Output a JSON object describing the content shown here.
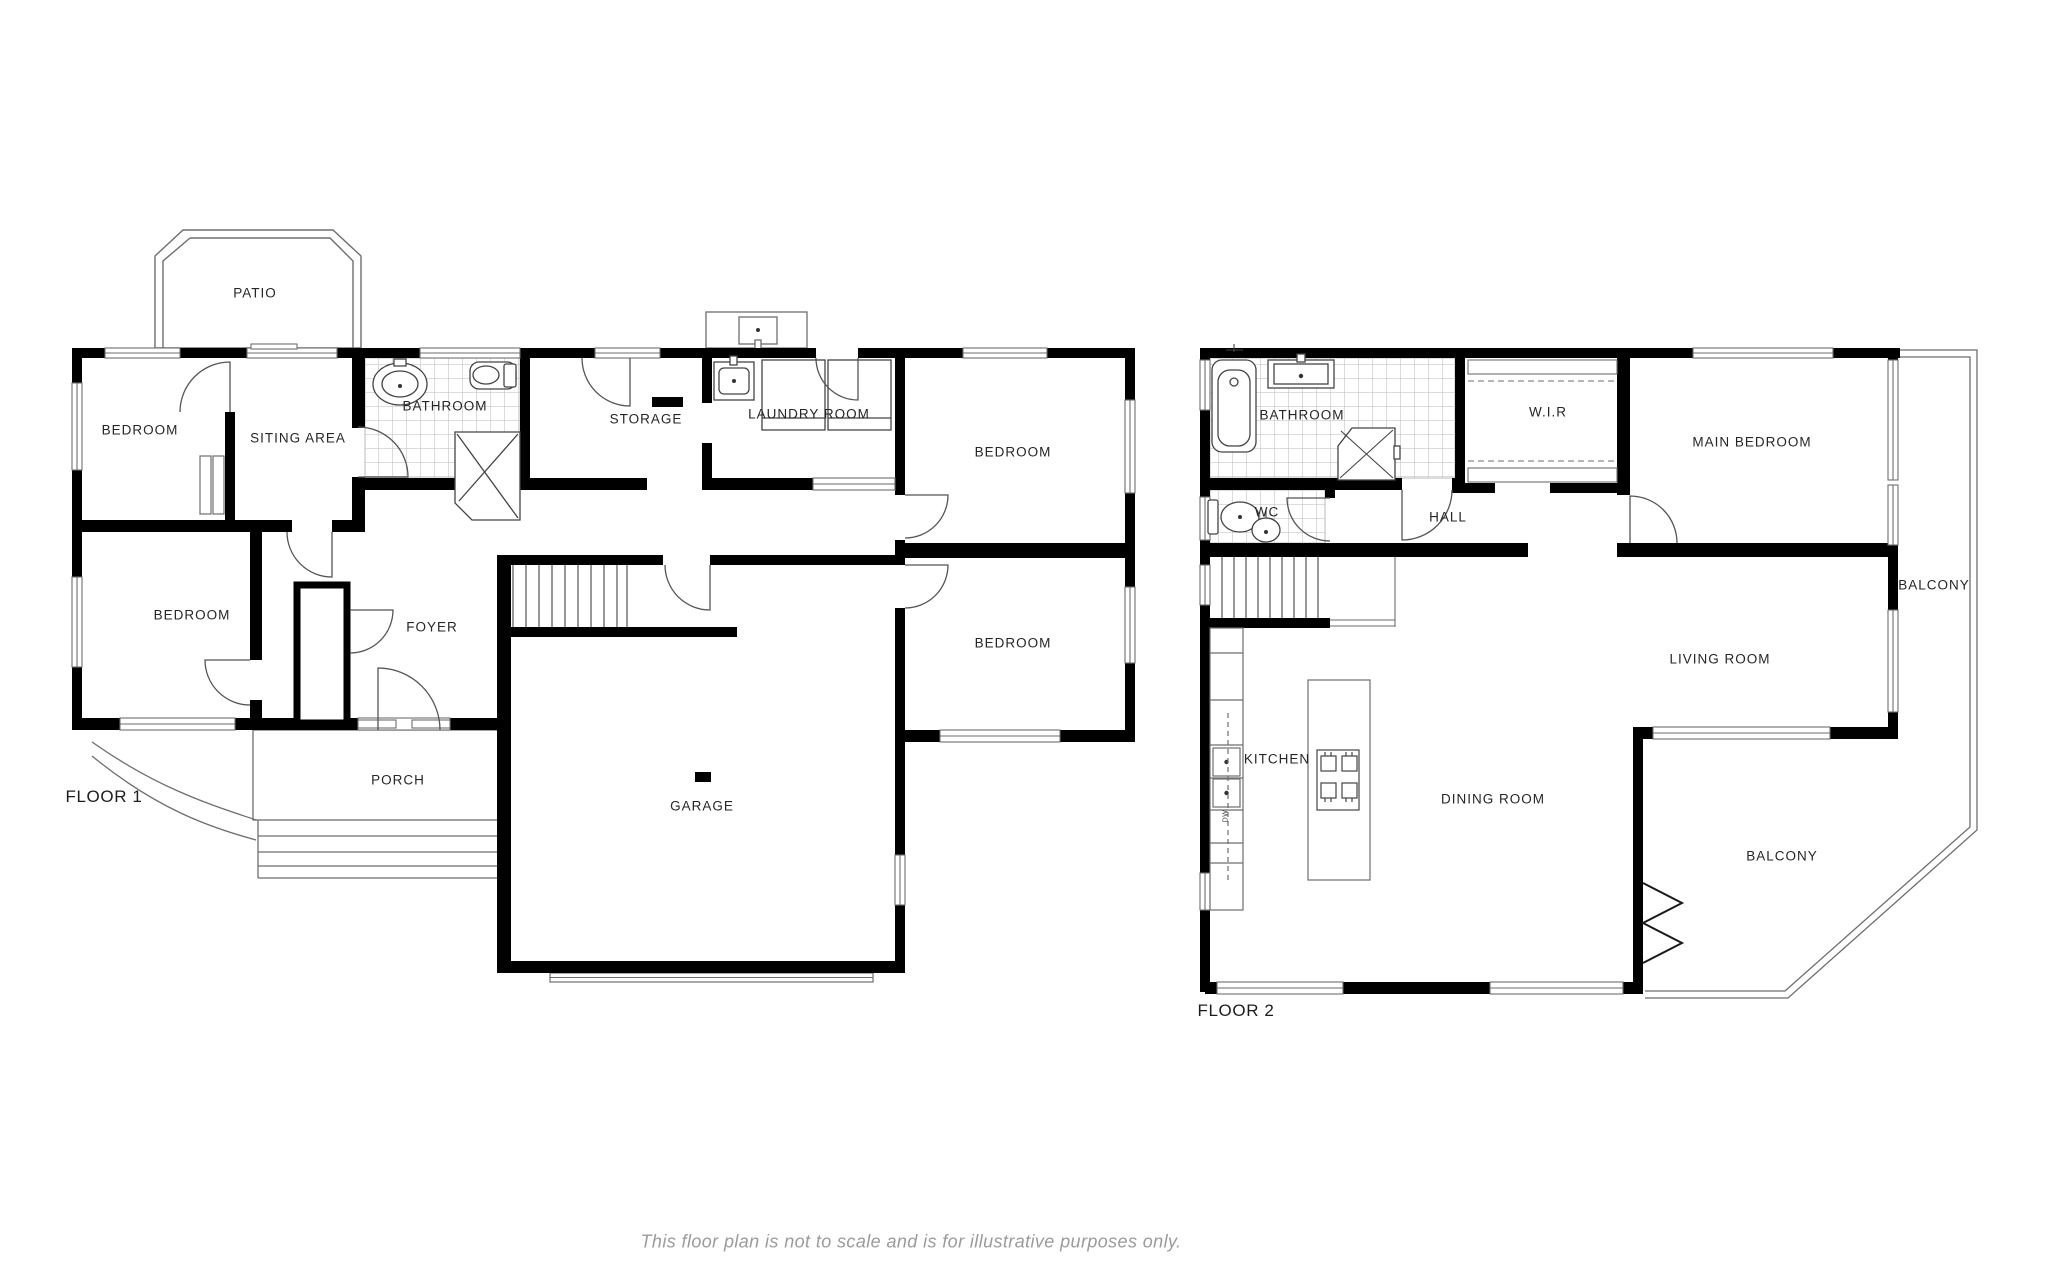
{
  "floor1": {
    "label": "FLOOR 1",
    "rooms": {
      "patio": "PATIO",
      "bedroom_top_left": "BEDROOM",
      "siting_area": "SITING AREA",
      "bathroom": "BATHROOM",
      "storage": "STORAGE",
      "laundry_room": "LAUNDRY ROOM",
      "bedroom_top_right": "BEDROOM",
      "bedroom_left": "BEDROOM",
      "foyer": "FOYER",
      "bedroom_right": "BEDROOM",
      "porch": "PORCH",
      "garage": "GARAGE"
    }
  },
  "floor2": {
    "label": "FLOOR 2",
    "rooms": {
      "bathroom": "BATHROOM",
      "wir": "W.I.R",
      "main_bedroom": "MAIN BEDROOM",
      "wc": "WC",
      "hall": "HALL",
      "balcony_right": "BALCONY",
      "living_room": "LIVING ROOM",
      "kitchen": "KITCHEN",
      "dining_room": "DINING ROOM",
      "balcony_bottom": "BALCONY"
    },
    "kitchen_appliance_label": "DW"
  },
  "caption": "This floor plan is not to scale and is for illustrative purposes only.",
  "colors": {
    "wall": "#000000",
    "thin_line": "#6e6e6e",
    "tile_line": "#b9b9b9",
    "label": "#262626",
    "caption": "#9b9b9b",
    "background": "#ffffff"
  }
}
